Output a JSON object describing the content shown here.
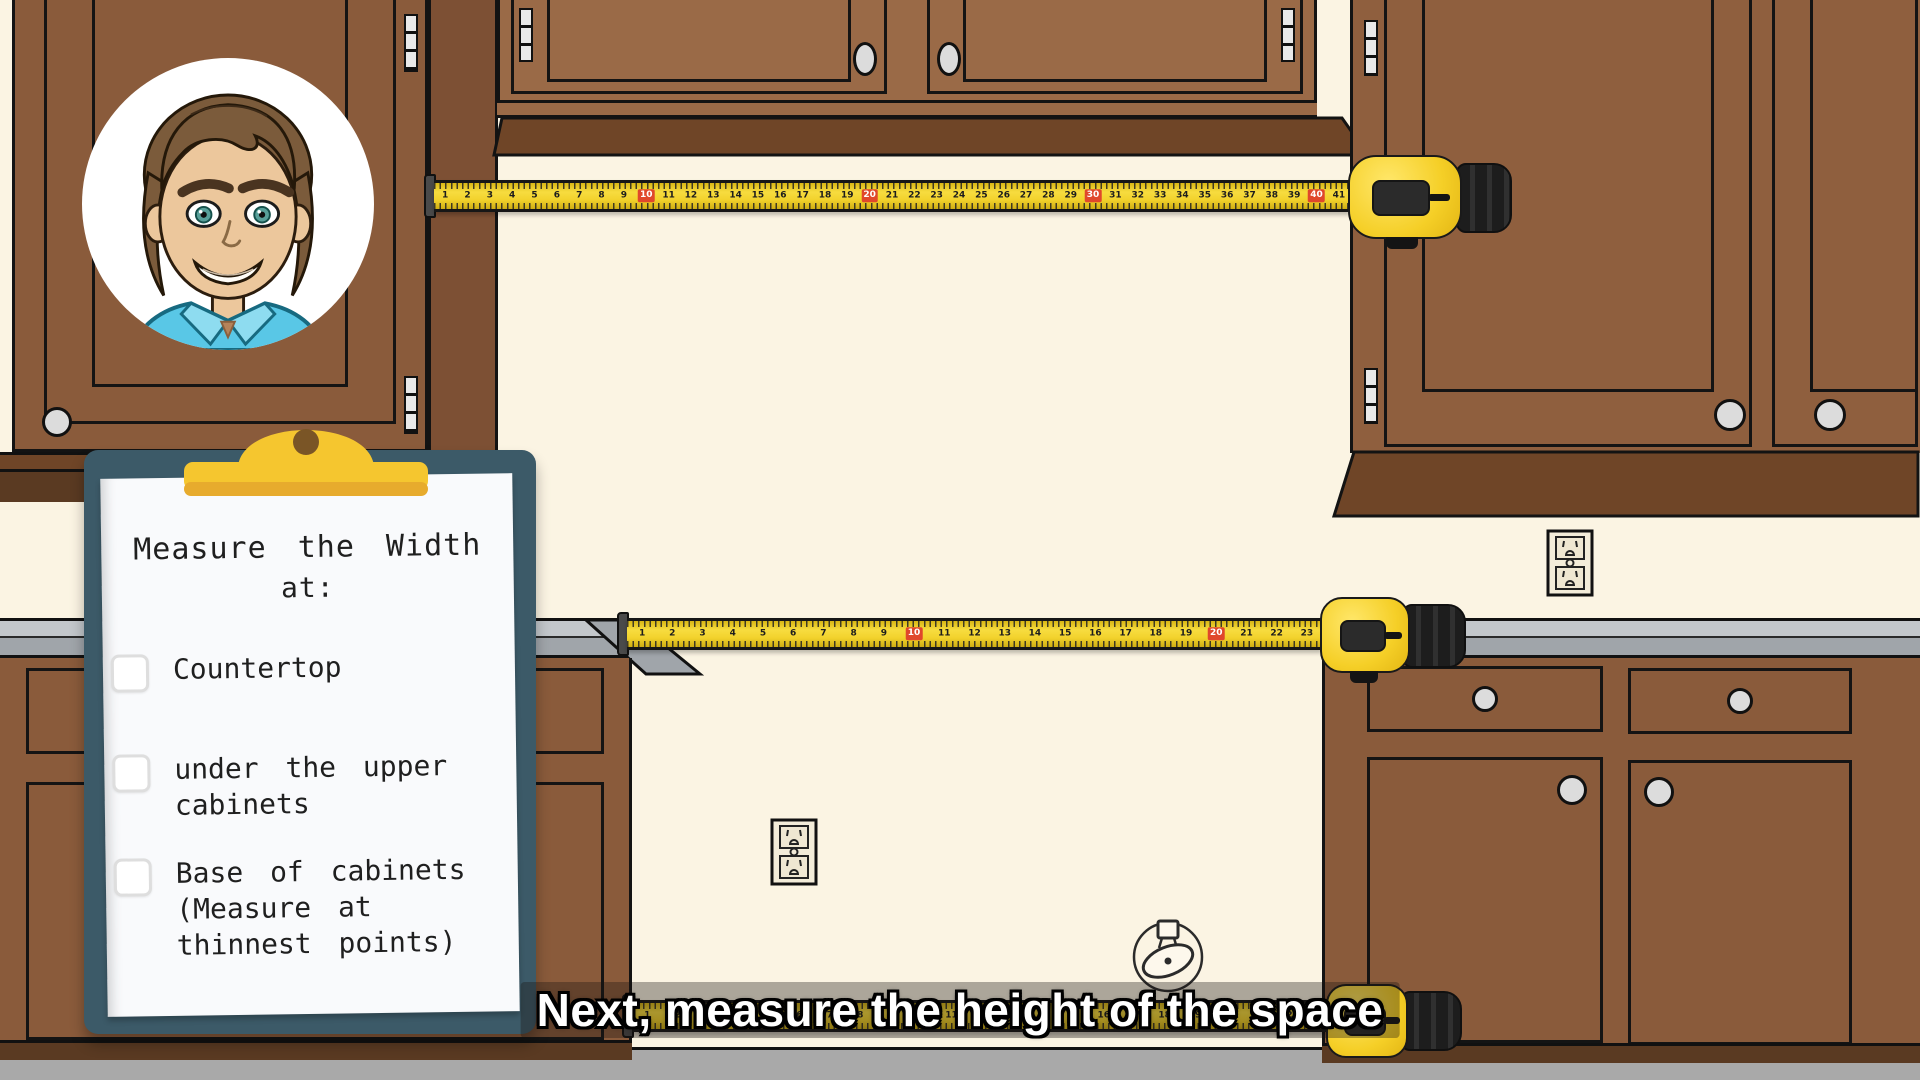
{
  "colors": {
    "wall": "#fbf4e3",
    "floor": "#a9a9a9",
    "cabA": "#8a5b3b",
    "cabASide": "#7d5034",
    "cabC": "#9a6a47",
    "cabD": "#8f5f3e",
    "cabLower": "#8a5b3b",
    "cabMold": "#6f4527",
    "cabMoldDark": "#5a3a22",
    "counterTop": "#c3c7cb",
    "counterSide": "#a0a5aa",
    "knob": "#dcdcdc",
    "tapeYellow": "#f2d22c",
    "tapeRed": "#e0472b",
    "board": "#3c5a68",
    "clip": "#f5c62f",
    "clipDark": "#e7ab2d",
    "clipHole": "#7a5526",
    "paper": "#f9fafc",
    "ink": "#1f1f1f",
    "captionBg": "rgba(25,20,16,0.35)",
    "captionText": "#ffffff"
  },
  "checklist": {
    "title_lines": [
      "Measure the Width",
      "at:"
    ],
    "items": [
      {
        "lines": [
          "Countertop"
        ],
        "checked": false
      },
      {
        "lines": [
          "under the upper",
          "cabinets"
        ],
        "checked": false
      },
      {
        "lines": [
          "Base of cabinets",
          "(Measure at",
          "thinnest points)"
        ],
        "checked": false
      }
    ]
  },
  "caption": {
    "text": "Next, measure the height of the space"
  },
  "tapes": [
    {
      "name": "upper-tape",
      "start": 1,
      "end": 41,
      "red_every": 10
    },
    {
      "name": "counter-tape",
      "start": 1,
      "end": 23,
      "red_every": 10
    },
    {
      "name": "floor-tape",
      "start": 1,
      "end": 23,
      "red_every": 10
    }
  ]
}
